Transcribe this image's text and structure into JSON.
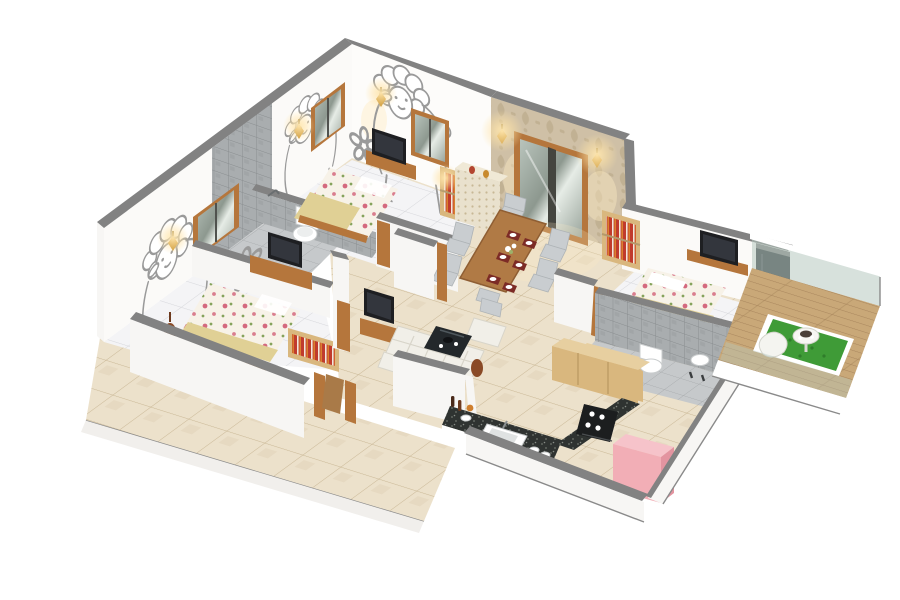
{
  "image": {
    "kind": "isometric-3d-floor-plan-render",
    "description": "Cutaway dollhouse-style 3D render of an apartment floor plan on a plain white background; white walls with grey cut tops, cream tiled common floors, two kids bedrooms with cartoon sheep wall art, dining room with beige damask wallpaper, living room, master bedroom, two grey-tiled bathrooms, kitchen with black granite counters and a wood-deck balcony with artificial grass.",
    "background": "#ffffff"
  },
  "rooms": [
    {
      "name": "kids-bedroom-1",
      "wall_decor": "cartoon sheep line art",
      "items": [
        "double bed with floral bedding and yellow blanket",
        "wall tv with wooden console",
        "two brown-framed windows",
        "gold wall sconces",
        "red book shelf"
      ]
    },
    {
      "name": "bathroom-1",
      "finish": "grey stone tiles",
      "items": [
        "toilet",
        "wall basin",
        "shower half-wall",
        "tiled tub platform"
      ]
    },
    {
      "name": "kids-bedroom-2",
      "wall_decor": "cartoon sheep line art",
      "items": [
        "double bed with floral bedding",
        "tv console",
        "brown-framed window",
        "floor vase",
        "book rack with red books"
      ]
    },
    {
      "name": "dining-room",
      "wall_decor": "beige damask wallpaper",
      "items": [
        "wooden six-seat dining table",
        "grey upholstered chairs",
        "red placemats with white plates",
        "flower centerpiece",
        "cream lattice sideboard",
        "large brown-framed window",
        "two gold sconces"
      ]
    },
    {
      "name": "living-room",
      "items": [
        "white l-shaped sofa",
        "dark glass coffee table with black tea set",
        "tv on wooden stand",
        "brown floor vase"
      ]
    },
    {
      "name": "master-bedroom",
      "items": [
        "double bed with floral bedding",
        "wall-mounted tv shelf",
        "bookshelf with red books"
      ]
    },
    {
      "name": "master-bathroom",
      "finish": "grey mosaic tiles",
      "items": [
        "toilet",
        "basin",
        "light-wood vanity cabinet",
        "shower taps"
      ]
    },
    {
      "name": "kitchen",
      "items": [
        "black granite l-shaped counter",
        "white sink",
        "gas hob",
        "stacked white plates",
        "wine bottles and fruit",
        "light-wood cabinet",
        "pink refrigerator"
      ]
    },
    {
      "name": "balcony",
      "items": [
        "wood plank deck",
        "artificial grass square with white border",
        "round white pedestal table with dark tray",
        "white lounge chair",
        "green glass railing with white rails"
      ]
    },
    {
      "name": "terrace",
      "finish": "cream floor tiles",
      "items": []
    }
  ],
  "palette": {
    "bg": "#ffffff",
    "wallTop": "#828282",
    "wallTopDark": "#6d6d6d",
    "wallFace": "#f7f6f4",
    "wallShade": "#e9e7e2",
    "artLine": "#9a9a9a",
    "woodFrame": "#b5763c",
    "woodDark": "#8a5526",
    "woodLight": "#d9b77e",
    "tv": "#1e1f22",
    "floorCream": "#ece1cb",
    "floorCreamLine": "#c9b795",
    "floorWhite": "#f4f4f6",
    "floorWhiteLine": "#d6d7db",
    "bathTile": "#a9adaf",
    "bathTileLine": "#898d8f",
    "bathFloor": "#c6c9cb",
    "bathFloorLine": "#a8abad",
    "damaskBase": "#cfc0a6",
    "damaskMotif": "#b5a383",
    "gold": "#c8922e",
    "glow": "#ffdf9e",
    "sofa": "#f1efe8",
    "sofaShade": "#d8d5ca",
    "tableWood": "#b07a45",
    "chairGrey": "#c9cdd0",
    "matRed": "#7c2b26",
    "bedBase": "#f7f2e8",
    "bedPink": "#d4697e",
    "bedGreen": "#86a35c",
    "blanket": "#e0d095",
    "granite": "#2f3331",
    "graniteDot": "#5f655f",
    "pink": "#f2aeb6",
    "pinkDark": "#e394a0",
    "grass": "#3f9b37",
    "grassDark": "#2f7d2a",
    "deck": "#c9a878",
    "deckLine": "#a8855c",
    "glass": "#b7c8bf",
    "darkGlass": "#2e3338",
    "outline": "#8a8a8a"
  }
}
